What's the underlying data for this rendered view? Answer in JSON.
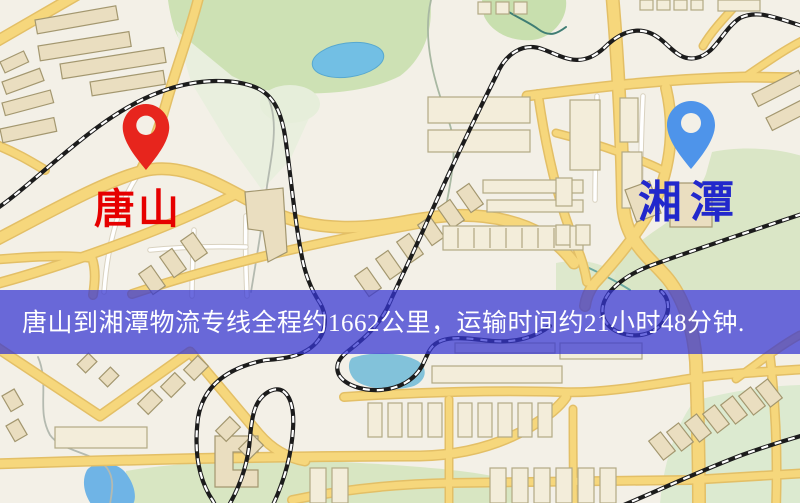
{
  "banner": {
    "text": "唐山到湘潭物流专线全程约1662公里，运输时间约21小时48分钟.",
    "bg_color": "rgba(54,54,210,0.73)",
    "text_color": "#ffffff"
  },
  "origin": {
    "label": "唐山",
    "label_color": "#e60000",
    "pin_color": "#e7251d",
    "pin_icon": "red-location-pin-icon"
  },
  "destination": {
    "label": "湘潭",
    "label_color": "#2228cc",
    "pin_color": "#4e94ea",
    "pin_icon": "blue-location-pin-icon"
  },
  "route": {
    "distance_km": "1662",
    "duration": "21小时48分钟"
  }
}
